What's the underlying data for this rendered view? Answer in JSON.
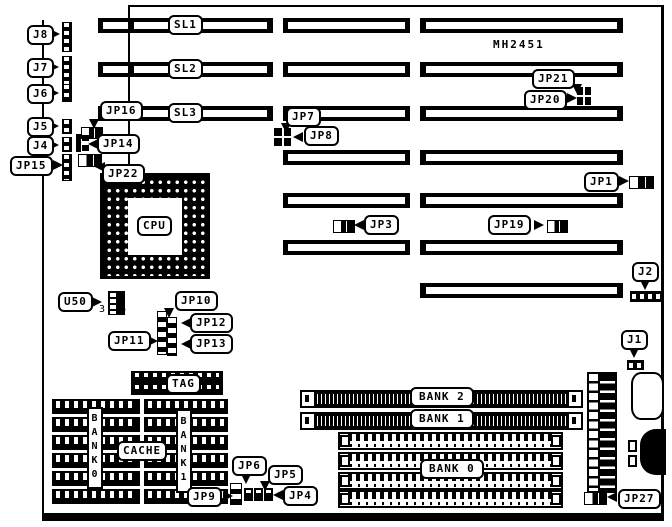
{
  "board": {
    "model": "MH2451"
  },
  "slot_labels": {
    "sl1": "SL1",
    "sl2": "SL2",
    "sl3": "SL3"
  },
  "cpu_label": "CPU",
  "callouts": {
    "j8": "J8",
    "j7": "J7",
    "j6": "J6",
    "j5": "J5",
    "j4": "J4",
    "jp15": "JP15",
    "jp16": "JP16",
    "jp14": "JP14",
    "jp22": "JP22",
    "jp7": "JP7",
    "jp8": "JP8",
    "jp21": "JP21",
    "jp20": "JP20",
    "jp1": "JP1",
    "jp3": "JP3",
    "jp19": "JP19",
    "j2": "J2",
    "j1": "J1",
    "jp27": "JP27",
    "u50": "U50",
    "jp10": "JP10",
    "jp11": "JP11",
    "jp12": "JP12",
    "jp13": "JP13",
    "jp6": "JP6",
    "jp5": "JP5",
    "jp9": "JP9",
    "jp4": "JP4",
    "tag": "TAG",
    "cache": "CACHE"
  },
  "memory": {
    "bank2": "BANK 2",
    "bank1": "BANK 1",
    "bank0": "BANK 0",
    "cache_bank0_vertical": "BANK0",
    "cache_bank1_vertical": "BANK1"
  },
  "u50_pins": {
    "pin3": "3",
    "pin6": "6"
  },
  "colors": {
    "ink": "#000000",
    "paper": "#ffffff"
  }
}
